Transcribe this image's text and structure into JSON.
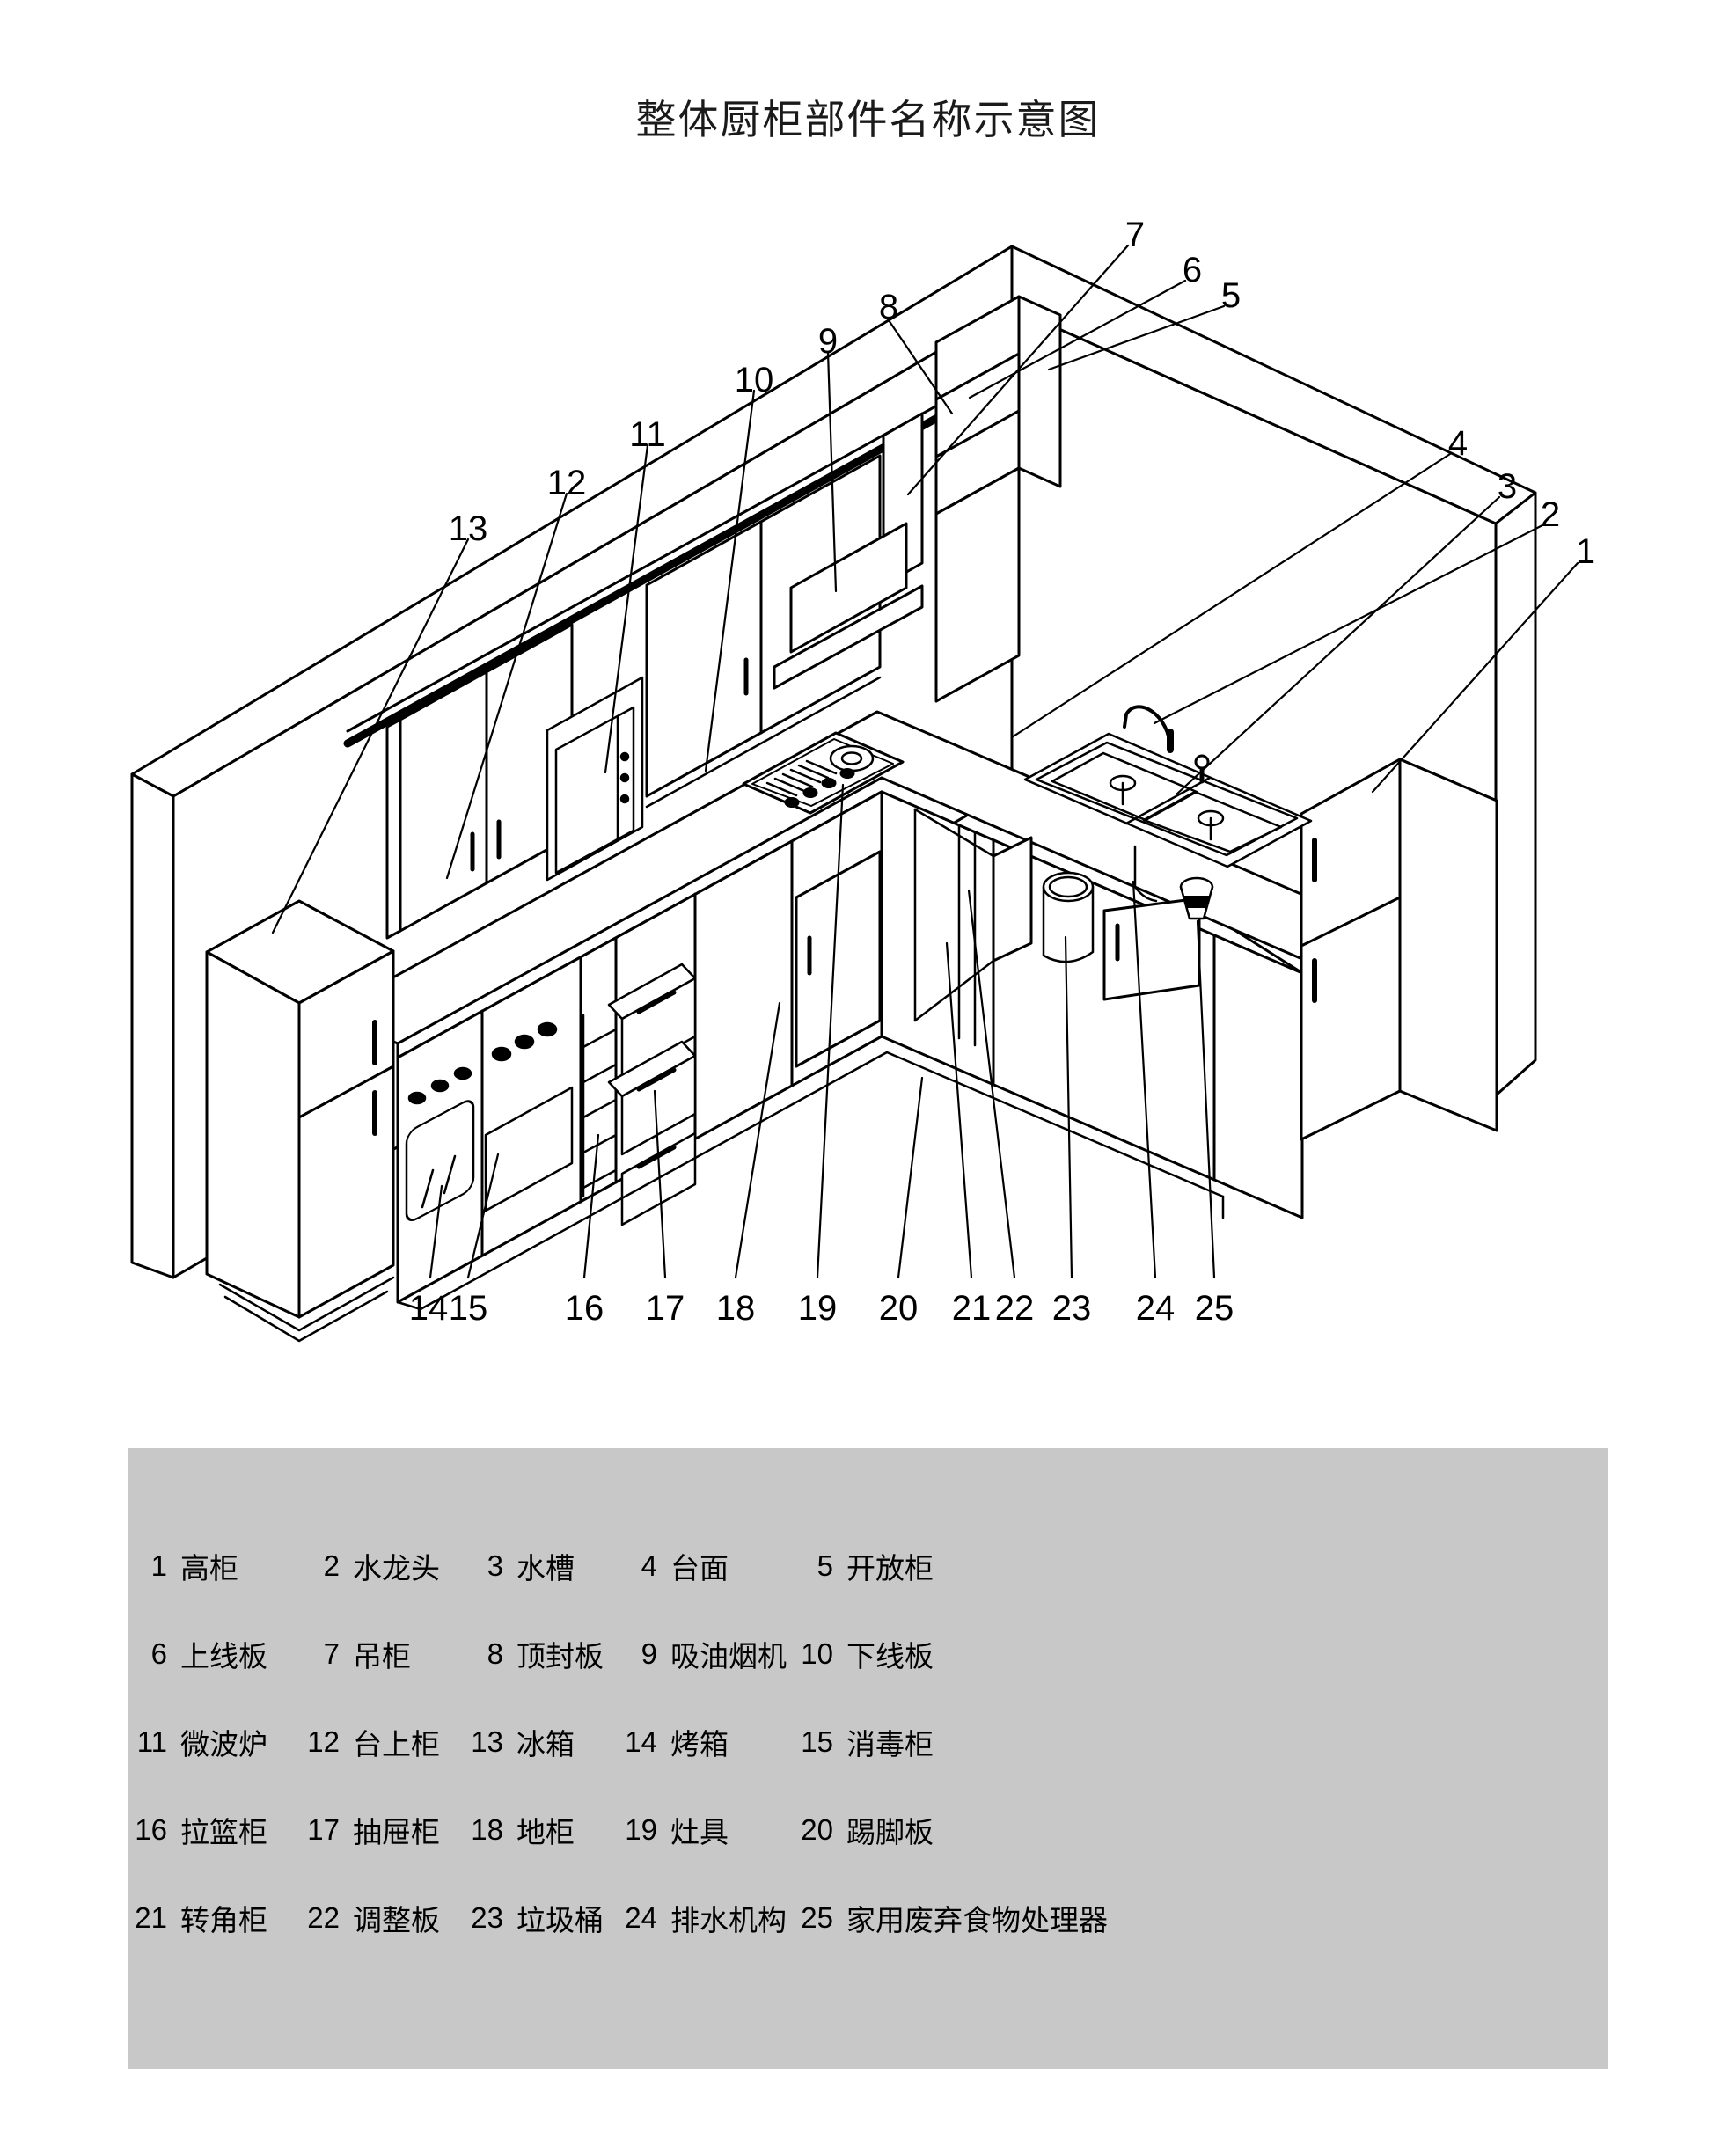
{
  "title": "整体厨柜部件名称示意图",
  "colors": {
    "line": "#000000",
    "legend_bg": "#c8c8c8",
    "background": "#ffffff"
  },
  "legend": {
    "items": [
      {
        "num": "1",
        "label": "高柜"
      },
      {
        "num": "2",
        "label": "水龙头"
      },
      {
        "num": "3",
        "label": "水槽"
      },
      {
        "num": "4",
        "label": "台面"
      },
      {
        "num": "5",
        "label": "开放柜"
      },
      {
        "num": "6",
        "label": "上线板"
      },
      {
        "num": "7",
        "label": "吊柜"
      },
      {
        "num": "8",
        "label": "顶封板"
      },
      {
        "num": "9",
        "label": "吸油烟机"
      },
      {
        "num": "10",
        "label": "下线板"
      },
      {
        "num": "11",
        "label": "微波炉"
      },
      {
        "num": "12",
        "label": "台上柜"
      },
      {
        "num": "13",
        "label": "冰箱"
      },
      {
        "num": "14",
        "label": "烤箱"
      },
      {
        "num": "15",
        "label": "消毒柜"
      },
      {
        "num": "16",
        "label": "拉篮柜"
      },
      {
        "num": "17",
        "label": "抽屉柜"
      },
      {
        "num": "18",
        "label": "地柜"
      },
      {
        "num": "19",
        "label": "灶具"
      },
      {
        "num": "20",
        "label": "踢脚板"
      },
      {
        "num": "21",
        "label": "转角柜"
      },
      {
        "num": "22",
        "label": "调整板"
      },
      {
        "num": "23",
        "label": "垃圾桶"
      },
      {
        "num": "24",
        "label": "排水机构"
      },
      {
        "num": "25",
        "label": "家用废弃食物处理器"
      }
    ]
  }
}
